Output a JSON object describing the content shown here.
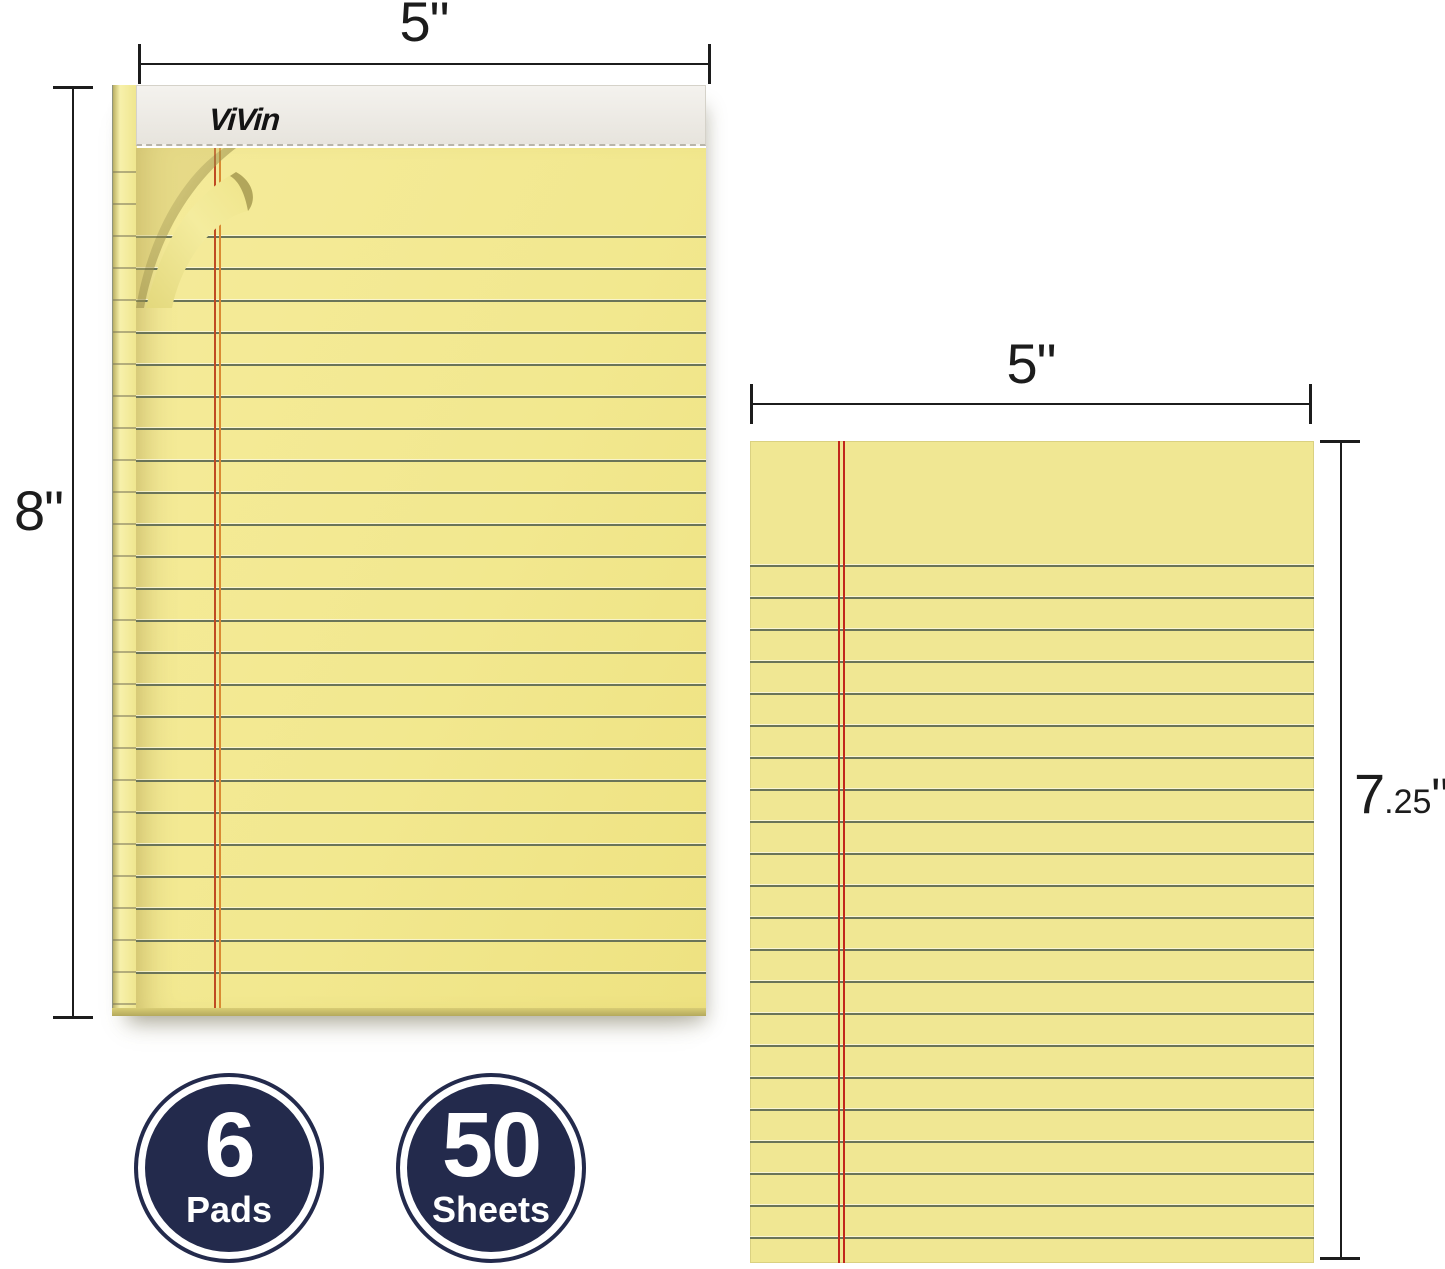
{
  "pad": {
    "brand": "ViVin"
  },
  "annotations": {
    "pad_width": "5\"",
    "pad_height": "8\"",
    "sheet_width": "5\"",
    "sheet_height_main": "7",
    "sheet_height_decimal": ".25",
    "sheet_height_unit": "\""
  },
  "badges": [
    {
      "value": "6",
      "label": "Pads"
    },
    {
      "value": "50",
      "label": "Sheets"
    }
  ],
  "colors": {
    "paper": "#f2e88f",
    "sheet_paper": "#f0e793",
    "rule_line": "#6a7458",
    "margin_red": "#bf4a22",
    "margin_orange": "#d98a33",
    "sheet_red": "#c1271c",
    "badge_navy": "#232a4c",
    "dim": "#1c1c1c",
    "strip": "#ebe8e2"
  }
}
